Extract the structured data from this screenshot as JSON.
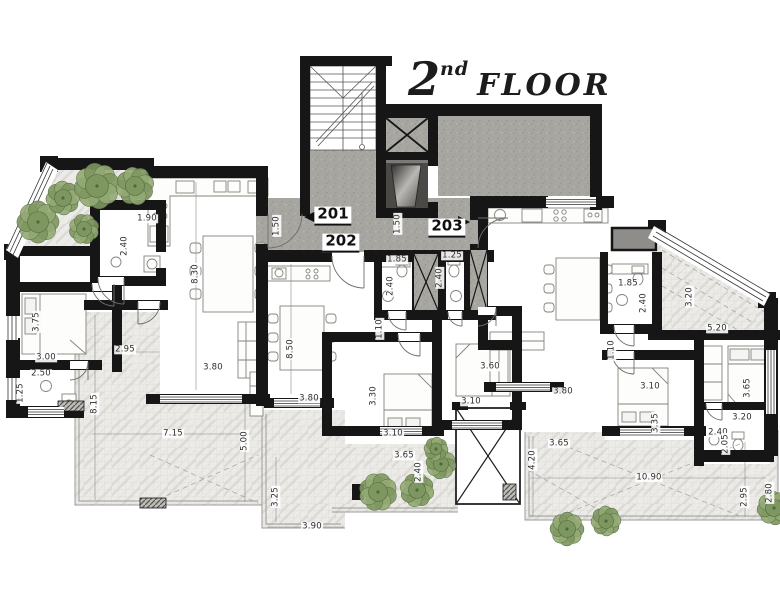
{
  "title": {
    "floor_number": "2",
    "ordinal_suffix": "nd",
    "floor_word": "FLOOR"
  },
  "units": [
    {
      "label": "201",
      "x": 333,
      "y": 216
    },
    {
      "label": "202",
      "x": 341,
      "y": 243
    },
    {
      "label": "203",
      "x": 447,
      "y": 228
    }
  ],
  "dimensions": [
    {
      "v": "1.90",
      "x": 147,
      "y": 219,
      "r": 0
    },
    {
      "v": "2.40",
      "x": 125,
      "y": 246,
      "r": 1
    },
    {
      "v": "8.30",
      "x": 196,
      "y": 274,
      "r": 1
    },
    {
      "v": "1.50",
      "x": 277,
      "y": 226,
      "r": 1
    },
    {
      "v": "1.50",
      "x": 398,
      "y": 224,
      "r": 1
    },
    {
      "v": "3.75",
      "x": 37,
      "y": 322,
      "r": 1
    },
    {
      "v": "3.00",
      "x": 46,
      "y": 358,
      "r": 0
    },
    {
      "v": "2.50",
      "x": 41,
      "y": 374,
      "r": 0
    },
    {
      "v": "1.25",
      "x": 21,
      "y": 393,
      "r": 1
    },
    {
      "v": "2.95",
      "x": 125,
      "y": 350,
      "r": 0
    },
    {
      "v": "3.80",
      "x": 213,
      "y": 368,
      "r": 0
    },
    {
      "v": "8.15",
      "x": 95,
      "y": 404,
      "r": 1
    },
    {
      "v": "7.15",
      "x": 173,
      "y": 434,
      "r": 0
    },
    {
      "v": "5.00",
      "x": 245,
      "y": 441,
      "r": 1
    },
    {
      "v": "8.50",
      "x": 291,
      "y": 349,
      "r": 1
    },
    {
      "v": "1.85",
      "x": 397,
      "y": 260,
      "r": 0
    },
    {
      "v": "2.40",
      "x": 391,
      "y": 286,
      "r": 1
    },
    {
      "v": "1.25",
      "x": 452,
      "y": 256,
      "r": 0
    },
    {
      "v": "2.40",
      "x": 440,
      "y": 278,
      "r": 1
    },
    {
      "v": "1.10",
      "x": 380,
      "y": 329,
      "r": 1
    },
    {
      "v": "3.80",
      "x": 309,
      "y": 399,
      "r": 0
    },
    {
      "v": "3.30",
      "x": 374,
      "y": 396,
      "r": 1
    },
    {
      "v": "3.10",
      "x": 471,
      "y": 402,
      "r": 0
    },
    {
      "v": "3.60",
      "x": 490,
      "y": 367,
      "r": 0
    },
    {
      "v": "3.10",
      "x": 393,
      "y": 434,
      "r": 0
    },
    {
      "v": "3.65",
      "x": 404,
      "y": 456,
      "r": 0
    },
    {
      "v": "2.40",
      "x": 419,
      "y": 472,
      "r": 1
    },
    {
      "v": "3.25",
      "x": 276,
      "y": 497,
      "r": 1
    },
    {
      "v": "3.90",
      "x": 312,
      "y": 527,
      "r": 0
    },
    {
      "v": "1.85",
      "x": 628,
      "y": 284,
      "r": 0
    },
    {
      "v": "2.40",
      "x": 644,
      "y": 303,
      "r": 1
    },
    {
      "v": "3.20",
      "x": 690,
      "y": 297,
      "r": 1
    },
    {
      "v": "5.20",
      "x": 717,
      "y": 329,
      "r": 0
    },
    {
      "v": "1.10",
      "x": 612,
      "y": 350,
      "r": 1
    },
    {
      "v": "3.80",
      "x": 563,
      "y": 392,
      "r": 0
    },
    {
      "v": "3.10",
      "x": 650,
      "y": 387,
      "r": 0
    },
    {
      "v": "3.65",
      "x": 748,
      "y": 388,
      "r": 1
    },
    {
      "v": "3.35",
      "x": 656,
      "y": 423,
      "r": 1
    },
    {
      "v": "3.20",
      "x": 742,
      "y": 418,
      "r": 0
    },
    {
      "v": "2.40",
      "x": 718,
      "y": 433,
      "r": 0
    },
    {
      "v": "2.05",
      "x": 726,
      "y": 444,
      "r": 1
    },
    {
      "v": "3.65",
      "x": 559,
      "y": 444,
      "r": 0
    },
    {
      "v": "4.20",
      "x": 533,
      "y": 460,
      "r": 1
    },
    {
      "v": "10.90",
      "x": 649,
      "y": 478,
      "r": 0
    },
    {
      "v": "2.95",
      "x": 745,
      "y": 497,
      "r": 1
    },
    {
      "v": "2.80",
      "x": 770,
      "y": 493,
      "r": 1
    }
  ],
  "plants": [
    {
      "x": 38,
      "y": 222,
      "r": 21
    },
    {
      "x": 63,
      "y": 198,
      "r": 17
    },
    {
      "x": 97,
      "y": 186,
      "r": 23
    },
    {
      "x": 135,
      "y": 186,
      "r": 19
    },
    {
      "x": 84,
      "y": 229,
      "r": 15
    },
    {
      "x": 378,
      "y": 492,
      "r": 19
    },
    {
      "x": 417,
      "y": 490,
      "r": 17
    },
    {
      "x": 441,
      "y": 464,
      "r": 15
    },
    {
      "x": 436,
      "y": 449,
      "r": 12
    },
    {
      "x": 567,
      "y": 529,
      "r": 17
    },
    {
      "x": 606,
      "y": 521,
      "r": 15
    },
    {
      "x": 774,
      "y": 508,
      "r": 17
    }
  ],
  "colors": {
    "wall": "#161616",
    "concrete": "#a8a6a1",
    "concrete_dark": "#8f8d89",
    "marble": "#ecebe8",
    "grid_line": "#d2d2ce",
    "plant": "#93a873",
    "plant2": "#7e9660",
    "plant_dark": "#4f6a3a",
    "dim_text": "#2e2e2e"
  }
}
